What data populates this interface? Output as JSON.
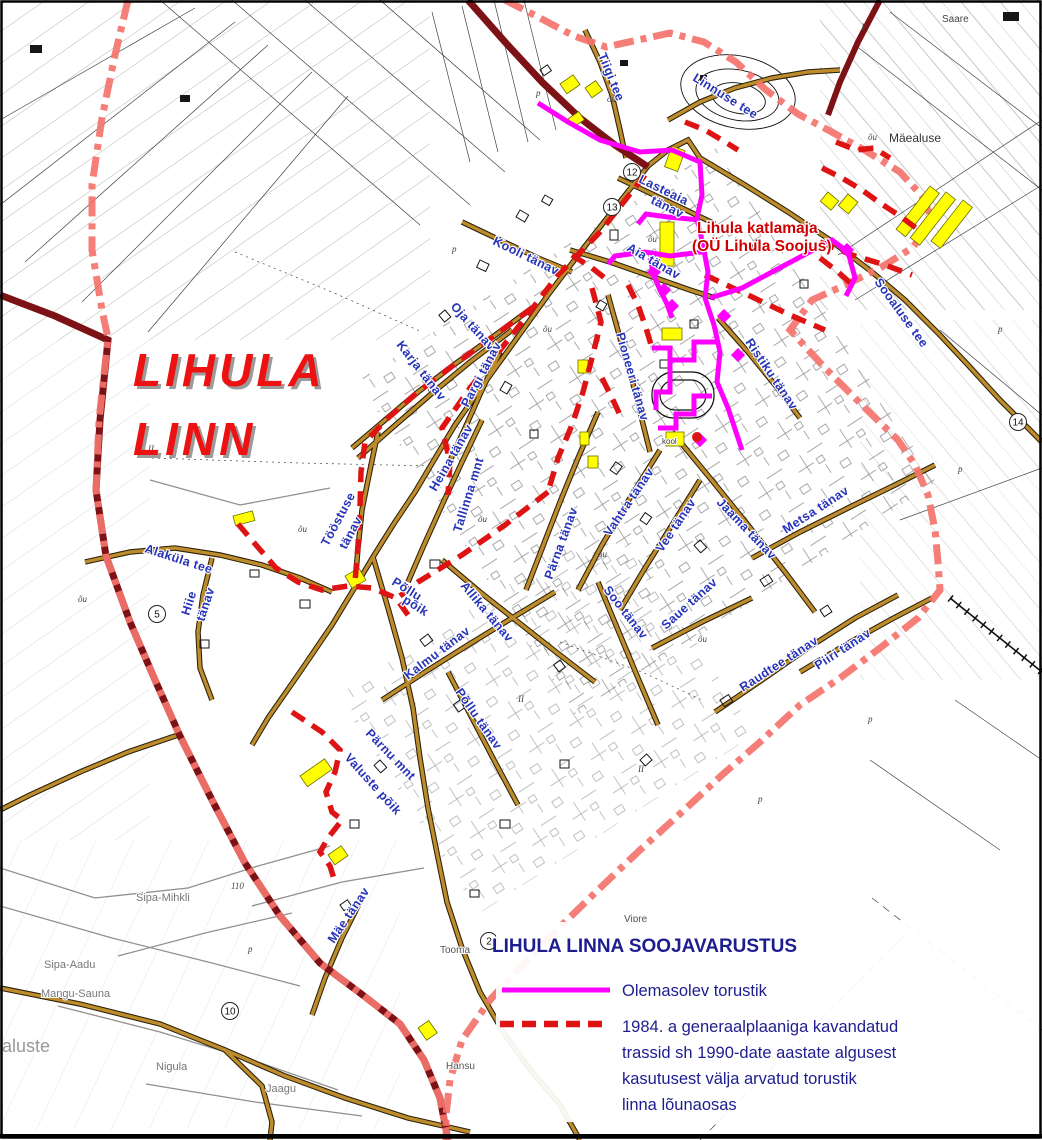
{
  "map": {
    "region_label": {
      "line1": "LIHULA",
      "line2": "LINN"
    },
    "boiler_label": {
      "line1": "Lihula katlamaja",
      "line2": "(OÜ Lihula Soojus)"
    },
    "street_labels": [
      {
        "text": "Tiigi tee",
        "x": 598,
        "y": 55,
        "r": 68
      },
      {
        "text": "Linnuse tee",
        "x": 692,
        "y": 80,
        "r": 32
      },
      {
        "text": "Lasteaia",
        "x": 638,
        "y": 182,
        "r": 26
      },
      {
        "text": "tänav",
        "x": 650,
        "y": 203,
        "r": 26
      },
      {
        "text": "Aia tänav",
        "x": 626,
        "y": 250,
        "r": 30
      },
      {
        "text": "Kooli tänav",
        "x": 492,
        "y": 244,
        "r": 26
      },
      {
        "text": "Oja tänav",
        "x": 450,
        "y": 307,
        "r": 48
      },
      {
        "text": "Karja tänav",
        "x": 396,
        "y": 345,
        "r": 52
      },
      {
        "text": "Pargi tänav",
        "x": 468,
        "y": 408,
        "r": -62
      },
      {
        "text": "Heina tänav",
        "x": 436,
        "y": 492,
        "r": -60
      },
      {
        "text": "Tallinna mnt",
        "x": 461,
        "y": 533,
        "r": -73
      },
      {
        "text": "Pärna tänav",
        "x": 552,
        "y": 580,
        "r": -70
      },
      {
        "text": "Vahtra tänav",
        "x": 610,
        "y": 537,
        "r": -56
      },
      {
        "text": "Vee tänav",
        "x": 662,
        "y": 553,
        "r": -56
      },
      {
        "text": "Soo tänav",
        "x": 603,
        "y": 590,
        "r": 52
      },
      {
        "text": "Saue tänav",
        "x": 666,
        "y": 630,
        "r": -42
      },
      {
        "text": "Allika tänav",
        "x": 460,
        "y": 586,
        "r": 50
      },
      {
        "text": "Kalmu tänav",
        "x": 408,
        "y": 680,
        "r": -37
      },
      {
        "text": "Põllu",
        "x": 391,
        "y": 584,
        "r": 32
      },
      {
        "text": "põik",
        "x": 402,
        "y": 602,
        "r": 32
      },
      {
        "text": "Põllu tänav",
        "x": 455,
        "y": 692,
        "r": 55
      },
      {
        "text": "Pärnu mnt",
        "x": 365,
        "y": 734,
        "r": 46
      },
      {
        "text": "Valuste põik",
        "x": 344,
        "y": 758,
        "r": 48
      },
      {
        "text": "Mäe tänav",
        "x": 334,
        "y": 944,
        "r": -56
      },
      {
        "text": "Alaküla tee",
        "x": 144,
        "y": 552,
        "r": 18
      },
      {
        "text": "Hiie",
        "x": 189,
        "y": 616,
        "r": -72
      },
      {
        "text": "tänav",
        "x": 204,
        "y": 622,
        "r": -72
      },
      {
        "text": "Tööstuse",
        "x": 328,
        "y": 547,
        "r": -62
      },
      {
        "text": "tänav",
        "x": 346,
        "y": 550,
        "r": -62
      },
      {
        "text": "Jaama tänav",
        "x": 716,
        "y": 503,
        "r": 46
      },
      {
        "text": "Metsa tänav",
        "x": 786,
        "y": 534,
        "r": -33
      },
      {
        "text": "Raudtee tänav",
        "x": 743,
        "y": 692,
        "r": -33
      },
      {
        "text": "Piiri tänav",
        "x": 818,
        "y": 670,
        "r": -33
      },
      {
        "text": "Ristiku tänav",
        "x": 745,
        "y": 342,
        "r": 56
      },
      {
        "text": "Pioneeri tänav",
        "x": 616,
        "y": 334,
        "r": 74
      },
      {
        "text": "Sooaluse tee",
        "x": 874,
        "y": 282,
        "r": 54
      }
    ],
    "place_labels": [
      {
        "text": "Mäealuse",
        "x": 889,
        "y": 142,
        "s": 12,
        "c": "#333333"
      },
      {
        "text": "Saare",
        "x": 942,
        "y": 22,
        "s": 10,
        "c": "#444444"
      },
      {
        "text": "Sipa-Mihkli",
        "x": 136,
        "y": 901,
        "s": 11,
        "c": "#777777"
      },
      {
        "text": "Sipa-Aadu",
        "x": 44,
        "y": 968,
        "s": 11,
        "c": "#777777"
      },
      {
        "text": "Mangu-Sauna",
        "x": 41,
        "y": 997,
        "s": 11,
        "c": "#777777"
      },
      {
        "text": "aluste",
        "x": 2,
        "y": 1052,
        "s": 18,
        "c": "#999999"
      },
      {
        "text": "Nigula",
        "x": 156,
        "y": 1070,
        "s": 11,
        "c": "#777777"
      },
      {
        "text": "Jaagu",
        "x": 266,
        "y": 1092,
        "s": 11,
        "c": "#777777"
      },
      {
        "text": "Tooma",
        "x": 440,
        "y": 953,
        "s": 10,
        "c": "#555555"
      },
      {
        "text": "Vipre",
        "x": 624,
        "y": 922,
        "s": 10,
        "c": "#555555"
      },
      {
        "text": "Hansu",
        "x": 446,
        "y": 1069,
        "s": 10,
        "c": "#555555"
      },
      {
        "text": "kool",
        "x": 662,
        "y": 444,
        "s": 8,
        "c": "#333333"
      }
    ],
    "circle_numbers": [
      {
        "n": "12",
        "x": 632,
        "y": 172
      },
      {
        "n": "13",
        "x": 612,
        "y": 207
      },
      {
        "n": "2",
        "x": 489,
        "y": 941
      },
      {
        "n": "5",
        "x": 157,
        "y": 614
      },
      {
        "n": "10",
        "x": 230,
        "y": 1011
      },
      {
        "n": "14",
        "x": 1018,
        "y": 422
      }
    ],
    "terrain_marks": [
      {
        "t": "p",
        "x": 536,
        "y": 96
      },
      {
        "t": "p",
        "x": 452,
        "y": 252
      },
      {
        "t": "õu",
        "x": 607,
        "y": 102
      },
      {
        "t": "õu",
        "x": 648,
        "y": 242
      },
      {
        "t": "õu",
        "x": 543,
        "y": 332
      },
      {
        "t": "õu",
        "x": 428,
        "y": 392
      },
      {
        "t": "õu",
        "x": 298,
        "y": 532
      },
      {
        "t": "õu",
        "x": 478,
        "y": 522
      },
      {
        "t": "õu",
        "x": 598,
        "y": 557
      },
      {
        "t": "õu",
        "x": 698,
        "y": 642
      },
      {
        "t": "II",
        "x": 518,
        "y": 702
      },
      {
        "t": "II",
        "x": 638,
        "y": 772
      },
      {
        "t": "p",
        "x": 758,
        "y": 802
      },
      {
        "t": "p",
        "x": 868,
        "y": 722
      },
      {
        "t": "p",
        "x": 958,
        "y": 472
      },
      {
        "t": "p",
        "x": 998,
        "y": 332
      },
      {
        "t": "II",
        "x": 148,
        "y": 452
      },
      {
        "t": "õu",
        "x": 78,
        "y": 602
      },
      {
        "t": "p",
        "x": 248,
        "y": 952
      },
      {
        "t": "110",
        "x": 231,
        "y": 889
      },
      {
        "t": "p",
        "x": 862,
        "y": 28
      },
      {
        "t": "õu",
        "x": 868,
        "y": 140
      }
    ]
  },
  "legend": {
    "title": "LIHULA LINNA SOOJAVARUSTUS",
    "items": [
      {
        "symbol": "magenta-solid-line",
        "label": "Olemasolev torustik"
      },
      {
        "symbol": "red-dashed-line",
        "label_lines": [
          "1984. a generaalplaaniga kavandatud",
          "trassid sh 1990-date aastate algusest",
          "kasutusest välja arvatud torustik",
          "linna lõunaosas"
        ]
      }
    ]
  },
  "colors": {
    "navy": "#1d1d8f",
    "magenta": "#ff00ff",
    "red_dashed": "#de1414",
    "boundary_salmon": "#f4736c",
    "highway_maroon": "#7d1216",
    "road_brown": "#bd8c2c",
    "street_label_blue": "#2633b8",
    "label_red": "#cc0000",
    "highlight_yellow": "#ffff00"
  }
}
